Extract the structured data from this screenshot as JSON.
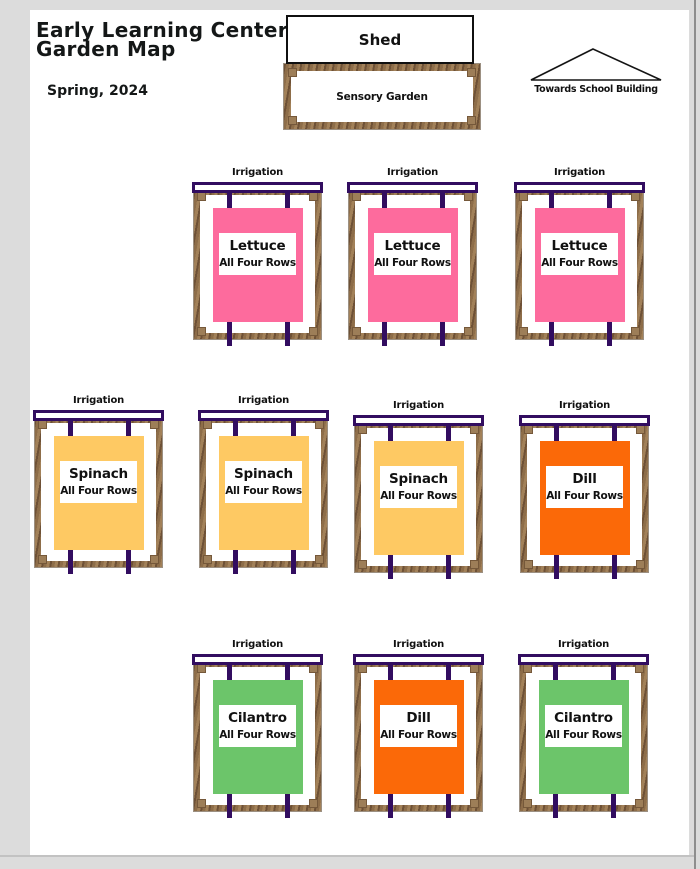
{
  "header": {
    "title_line1": "Early Learning Center",
    "title_line2": "Garden Map",
    "season": "Spring, 2024"
  },
  "shed": {
    "label": "Shed"
  },
  "sensory_garden": {
    "label": "Sensory Garden"
  },
  "direction": {
    "label": "Towards School Building",
    "icon": "roof-triangle-icon"
  },
  "beds": {
    "irrigation_label": "Irrigation",
    "rows_label": "All Four Rows",
    "crop_colors": {
      "Lettuce": "#fd6b9d",
      "Spinach": "#fec963",
      "Dill": "#fb6908",
      "Cilantro": "#6cc56a"
    },
    "items": [
      {
        "crop": "Lettuce",
        "row": 1,
        "x": 192,
        "y": 167
      },
      {
        "crop": "Lettuce",
        "row": 1,
        "x": 347,
        "y": 167
      },
      {
        "crop": "Lettuce",
        "row": 1,
        "x": 514,
        "y": 167
      },
      {
        "crop": "Spinach",
        "row": 2,
        "x": 33,
        "y": 395
      },
      {
        "crop": "Spinach",
        "row": 2,
        "x": 198,
        "y": 395
      },
      {
        "crop": "Spinach",
        "row": 2,
        "x": 353,
        "y": 400
      },
      {
        "crop": "Dill",
        "row": 2,
        "x": 519,
        "y": 400
      },
      {
        "crop": "Cilantro",
        "row": 3,
        "x": 192,
        "y": 639
      },
      {
        "crop": "Dill",
        "row": 3,
        "x": 353,
        "y": 639
      },
      {
        "crop": "Cilantro",
        "row": 3,
        "x": 518,
        "y": 639
      }
    ]
  },
  "colors": {
    "irrigation_purple": "#320d60",
    "wood_brown": "#8a6a49",
    "page_background": "#ffffff",
    "canvas_background": "#dcdcdc"
  }
}
